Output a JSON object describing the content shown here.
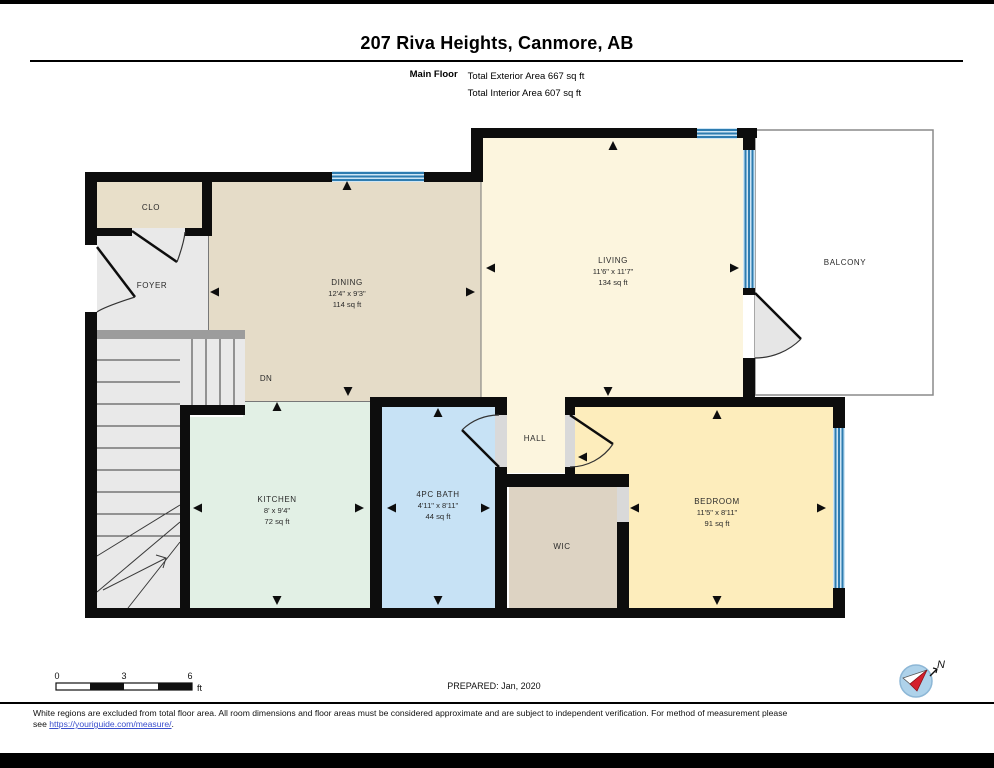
{
  "header": {
    "title": "207 Riva Heights, Canmore, AB",
    "floor_label": "Main Floor",
    "exterior_area": "Total Exterior Area 667 sq ft",
    "interior_area": "Total Interior Area 607 sq ft"
  },
  "rooms": {
    "clo": {
      "name": "CLO"
    },
    "foyer": {
      "name": "FOYER"
    },
    "dining": {
      "name": "DINING",
      "dims": "12'4\" x 9'3\"",
      "area": "114 sq ft"
    },
    "living": {
      "name": "LIVING",
      "dims": "11'6\" x 11'7\"",
      "area": "134 sq ft"
    },
    "balcony": {
      "name": "BALCONY"
    },
    "kitchen": {
      "name": "KITCHEN",
      "dims": "8' x 9'4\"",
      "area": "72 sq ft"
    },
    "bath": {
      "name": "4PC BATH",
      "dims": "4'11\" x 8'11\"",
      "area": "44 sq ft"
    },
    "hall": {
      "name": "HALL"
    },
    "wic": {
      "name": "WIC"
    },
    "bedroom": {
      "name": "BEDROOM",
      "dims": "11'5\" x 8'11\"",
      "area": "91 sq ft"
    }
  },
  "stairs": {
    "label": "DN"
  },
  "scale_bar": {
    "ticks": [
      "0",
      "3",
      "6"
    ],
    "unit": "ft"
  },
  "prepared_label": "PREPARED: Jan, 2020",
  "compass": {
    "label": "N"
  },
  "footer": {
    "line1": "White regions are excluded from total floor area. All room dimensions and floor areas must be considered approximate and are subject to independent verification. For method of measurement please",
    "line2_prefix": "see ",
    "link_text": "https://youriguide.com/measure/",
    "line2_suffix": "."
  },
  "colors": {
    "wall": "#0d0d0d",
    "dining_tan": "#e5dcc8",
    "foyer_gray": "#e9e9e9",
    "living_cream": "#fcf5de",
    "bedroom_wheat": "#fdedbc",
    "kitchen_mint": "#e2f0e5",
    "bath_blue": "#c7e2f5",
    "wic_tan": "#ddd3c3",
    "window_blue": "#2e7cb0",
    "link_blue": "#3a4ecc"
  }
}
